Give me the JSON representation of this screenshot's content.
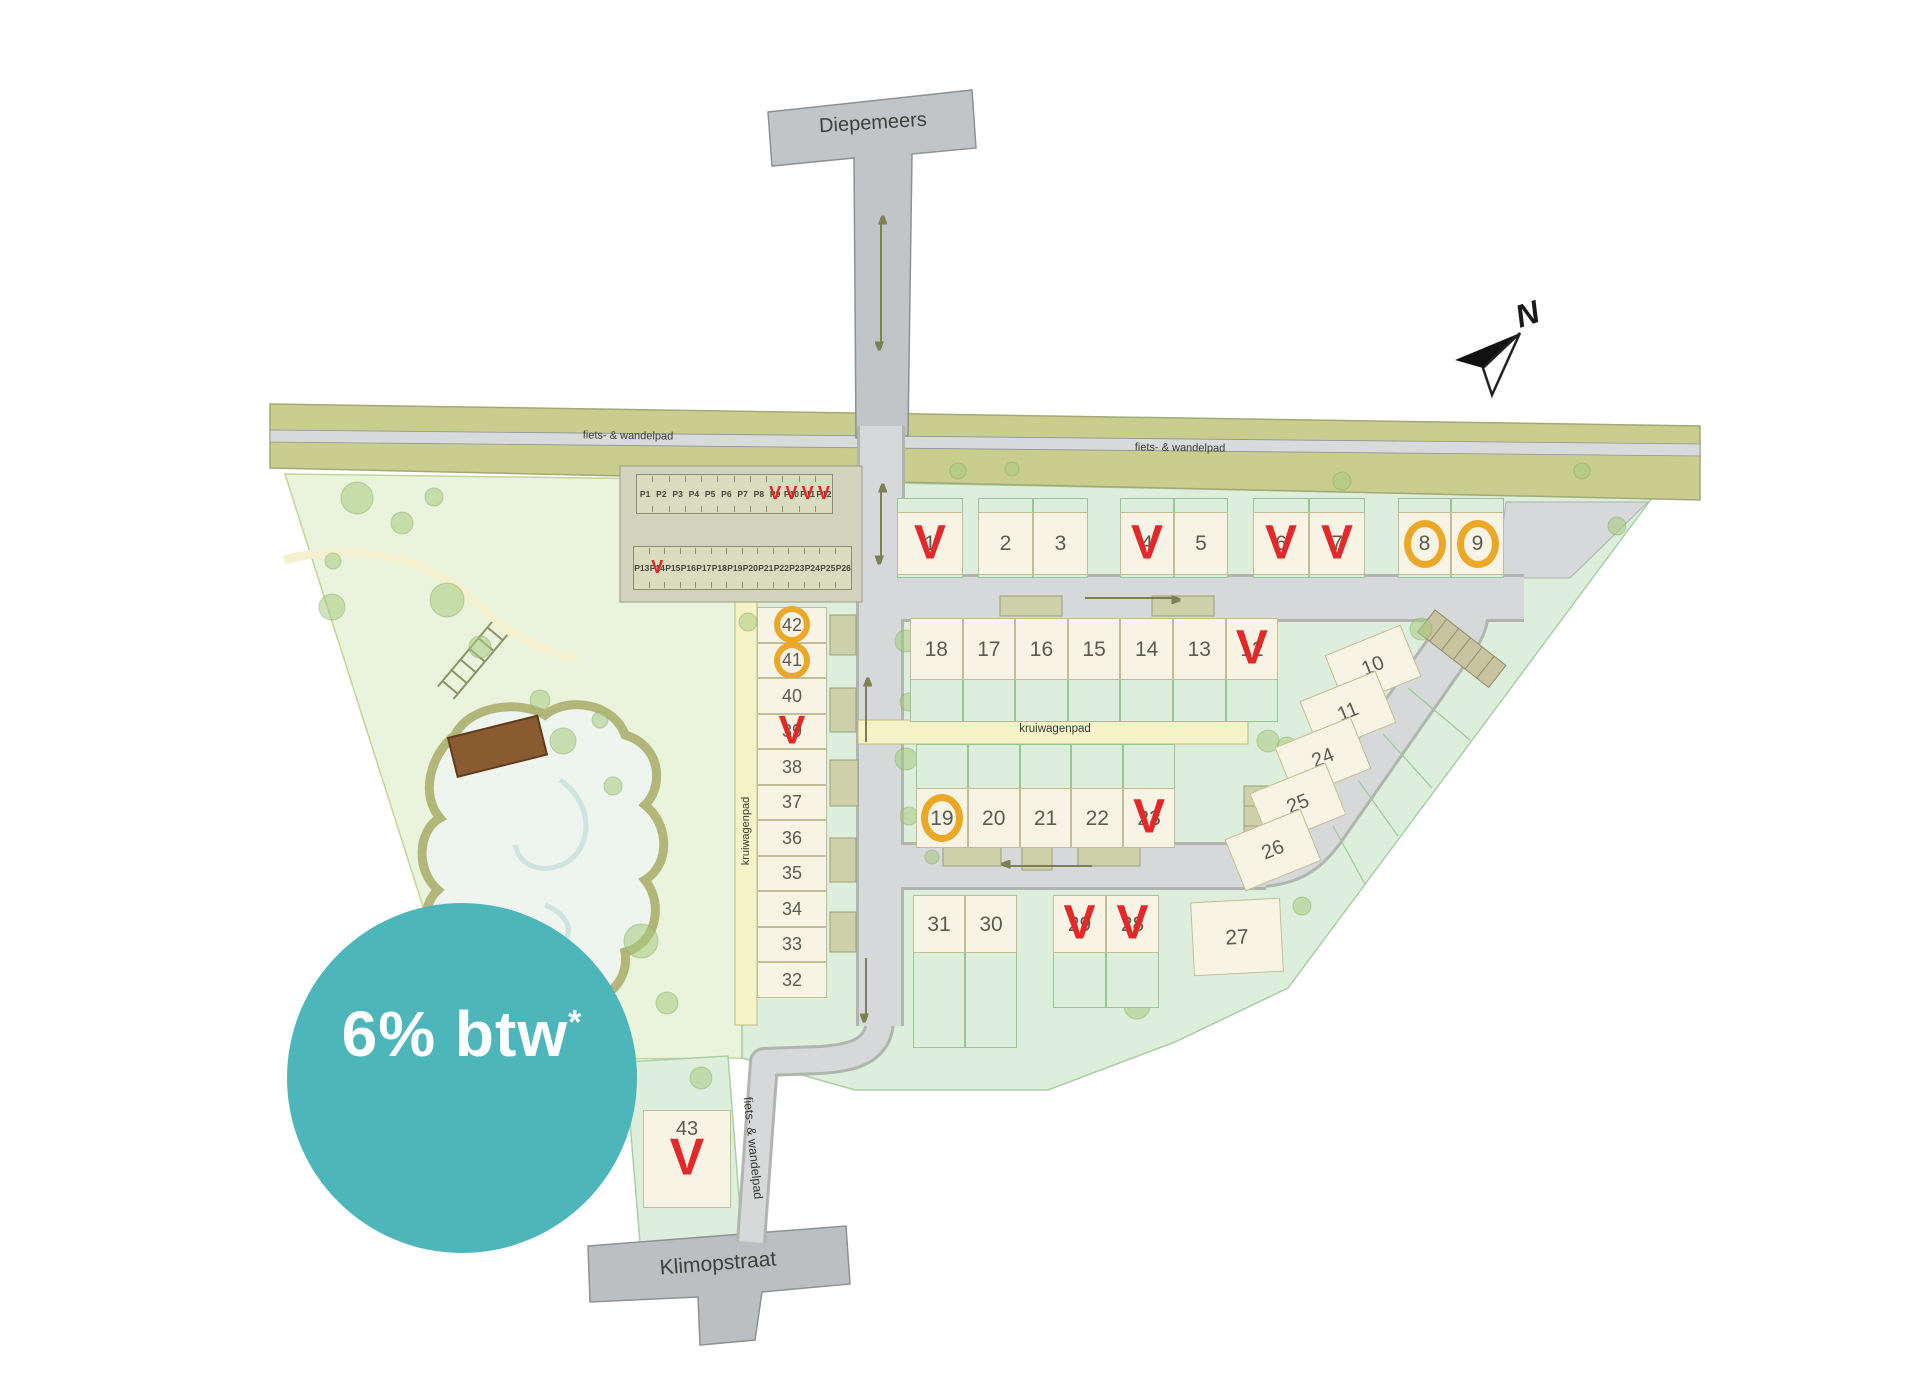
{
  "colors": {
    "sold": "#e3282a",
    "option": "#eaa826",
    "badge": "#4db6ba"
  },
  "badge": {
    "text": "6% btw",
    "superscript": "*"
  },
  "compass": {
    "north": "N"
  },
  "streets": {
    "top": "Diepemeers",
    "bottom": "Klimopstraat"
  },
  "path_labels": {
    "band_left": "fiets- & wandelpad",
    "band_right": "fiets- & wandelpad",
    "south_path": "fiets- & wandelpad",
    "kruiwagenpad_h": "kruiwagenpad",
    "kruiwagenpad_v": "kruiwagenpad"
  },
  "marks": {
    "sold": "V"
  },
  "lots": {
    "1": "sold",
    "2": "available",
    "3": "available",
    "4": "sold",
    "5": "available",
    "6": "sold",
    "7": "sold",
    "8": "option",
    "9": "option",
    "10": "available",
    "11": "available",
    "12": "sold",
    "13": "available",
    "14": "available",
    "15": "available",
    "16": "available",
    "17": "available",
    "18": "available",
    "19": "option",
    "20": "available",
    "21": "available",
    "22": "available",
    "23": "sold",
    "24": "available",
    "25": "available",
    "26": "available",
    "27": "available",
    "28": "sold",
    "29": "sold",
    "30": "available",
    "31": "available",
    "32": "available",
    "33": "available",
    "34": "available",
    "35": "available",
    "36": "available",
    "37": "available",
    "38": "available",
    "39": "sold",
    "40": "available",
    "41": "option",
    "42": "option",
    "43": "sold"
  },
  "parking_row_1": [
    {
      "label": "P1",
      "status": "available"
    },
    {
      "label": "P2",
      "status": "available"
    },
    {
      "label": "P3",
      "status": "available"
    },
    {
      "label": "P4",
      "status": "available"
    },
    {
      "label": "P5",
      "status": "available"
    },
    {
      "label": "P6",
      "status": "available"
    },
    {
      "label": "P7",
      "status": "available"
    },
    {
      "label": "P8",
      "status": "available"
    },
    {
      "label": "P9",
      "status": "sold"
    },
    {
      "label": "P10",
      "status": "sold"
    },
    {
      "label": "P11",
      "status": "sold"
    },
    {
      "label": "P12",
      "status": "sold"
    }
  ],
  "parking_row_2": [
    {
      "label": "P13",
      "status": "available"
    },
    {
      "label": "P14",
      "status": "sold"
    },
    {
      "label": "P15",
      "status": "available"
    },
    {
      "label": "P16",
      "status": "available"
    },
    {
      "label": "P17",
      "status": "available"
    },
    {
      "label": "P18",
      "status": "available"
    },
    {
      "label": "P19",
      "status": "available"
    },
    {
      "label": "P20",
      "status": "available"
    },
    {
      "label": "P21",
      "status": "available"
    },
    {
      "label": "P22",
      "status": "available"
    },
    {
      "label": "P23",
      "status": "available"
    },
    {
      "label": "P24",
      "status": "available"
    },
    {
      "label": "P25",
      "status": "available"
    },
    {
      "label": "P26",
      "status": "available"
    }
  ]
}
